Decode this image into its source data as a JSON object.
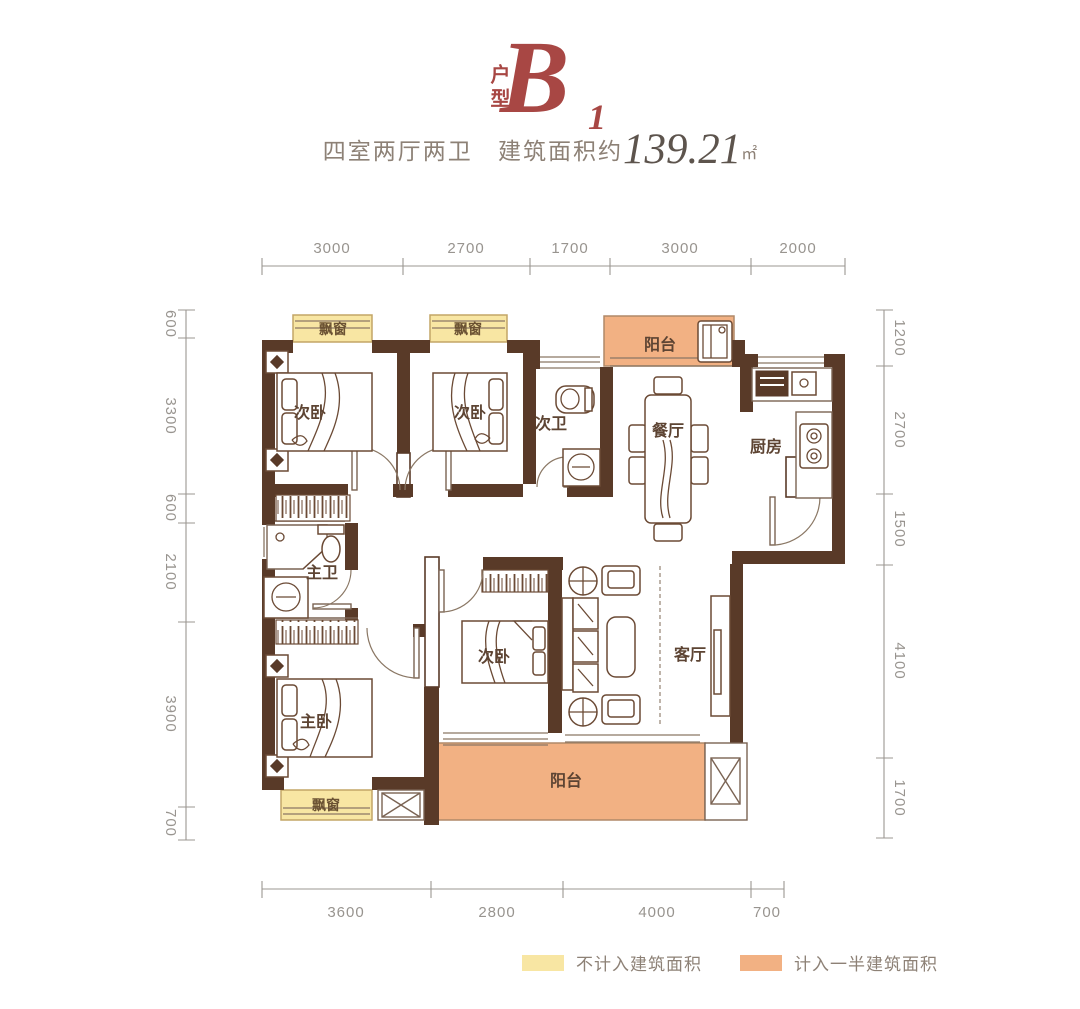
{
  "title": {
    "category_vertical": "户型",
    "unit_letter": "B",
    "unit_index": "1"
  },
  "subtitle": {
    "layout": "四室两厅两卫",
    "area_prefix": "建筑面积约",
    "area_value": "139.21",
    "area_unit": "㎡"
  },
  "dimensions": {
    "top": [
      "3000",
      "2700",
      "1700",
      "3000",
      "2000"
    ],
    "left": [
      "600",
      "3300",
      "600",
      "2100",
      "3900",
      "700"
    ],
    "right": [
      "1200",
      "2700",
      "1500",
      "4100",
      "1700"
    ],
    "bottom": [
      "3600",
      "2800",
      "4000",
      "700"
    ]
  },
  "rooms": {
    "bay_window": "飘窗",
    "secondary_bedroom": "次卧",
    "secondary_bath": "次卫",
    "dining": "餐厅",
    "kitchen": "厨房",
    "balcony": "阳台",
    "master_bath": "主卫",
    "living": "客厅",
    "master_bedroom": "主卧"
  },
  "legend": {
    "items": [
      {
        "label": "不计入建筑面积",
        "color": "#f8e6a3"
      },
      {
        "label": "计入一半建筑面积",
        "color": "#f2b183"
      }
    ]
  },
  "colors": {
    "wall": "#593a28",
    "bay_window_fill": "#f8e6a3",
    "balcony_fill": "#f2b183",
    "accent_red": "#a84744",
    "dimension_text": "#98948f",
    "room_label": "#5d4433",
    "subtitle_text": "#8d8176"
  }
}
